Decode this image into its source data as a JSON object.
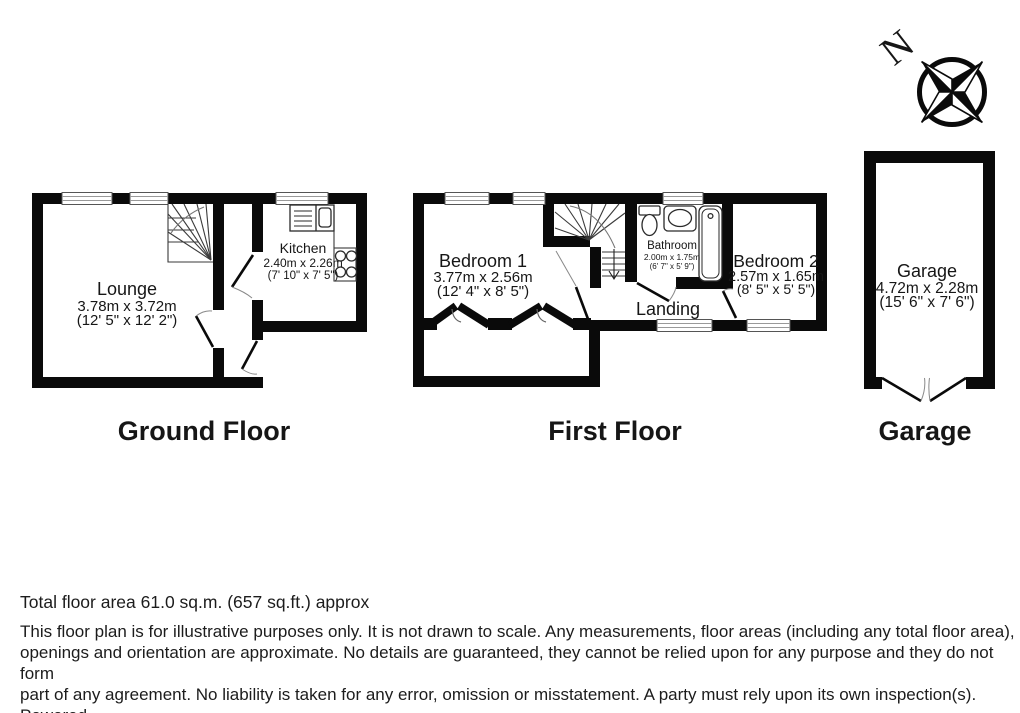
{
  "compass": {
    "north_label": "N"
  },
  "floors": {
    "ground": {
      "title": "Ground Floor",
      "rooms": {
        "lounge": {
          "name": "Lounge",
          "metric": "3.78m x 3.72m",
          "imperial": "(12' 5\" x 12' 2\")"
        },
        "kitchen": {
          "name": "Kitchen",
          "metric": "2.40m x 2.26m",
          "imperial": "(7' 10\" x 7' 5\")"
        }
      }
    },
    "first": {
      "title": "First Floor",
      "rooms": {
        "bedroom1": {
          "name": "Bedroom 1",
          "metric": "3.77m x 2.56m",
          "imperial": "(12' 4\" x 8' 5\")"
        },
        "bathroom": {
          "name": "Bathroom",
          "metric": "2.00m x 1.75m",
          "imperial": "(6' 7\" x 5' 9\")"
        },
        "bedroom2": {
          "name": "Bedroom 2",
          "metric": "2.57m x 1.65m",
          "imperial": "(8' 5\" x 5' 5\")"
        },
        "landing": {
          "name": "Landing"
        }
      }
    },
    "garage": {
      "title": "Garage",
      "rooms": {
        "garage": {
          "name": "Garage",
          "metric": "4.72m x 2.28m",
          "imperial": "(15' 6\" x 7' 6\")"
        }
      }
    }
  },
  "footer": {
    "total_area": "Total floor area 61.0 sq.m. (657 sq.ft.) approx",
    "disclaimer_lines": [
      "This floor plan is for illustrative purposes only. It is not drawn to scale. Any measurements, floor areas (including any total floor area),",
      "openings and orientation are approximate. No details are guaranteed, they cannot be relied upon for any purpose and they do not form",
      "part of any agreement. No liability is taken for any error, omission or misstatement. A party must rely upon its own inspection(s). Powered",
      "by www.focalagent.com"
    ]
  },
  "colors": {
    "wall": "#0a0a0a",
    "background": "#ffffff",
    "text": "#161616",
    "window_line": "#999999"
  }
}
